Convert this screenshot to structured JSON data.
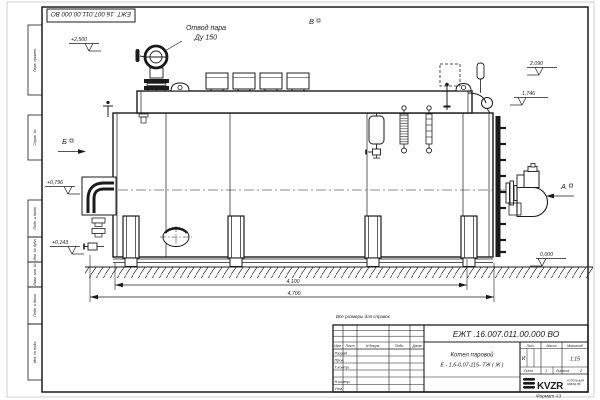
{
  "sheet": {
    "top_doc_number": "ЕЖТ .16.007.011.00.000  ВО",
    "reference_note": "Все размеры для справок",
    "format_note": "Формат  А3"
  },
  "frame_stamps": [
    "Перв. примен.",
    "Справ. №",
    "Подп. и дата",
    "Инв. № дубл.",
    "Взам. инв. №",
    "Подп. и дата",
    "Инв. № подл."
  ],
  "callouts": {
    "steam_outlet_line1": "Отвод пара",
    "steam_outlet_line2": "Ду 150",
    "view_b": "Б",
    "view_v": "В",
    "view_a": "А"
  },
  "elevations": {
    "valve_top": "+2,500",
    "drum_top": "2,090",
    "upper": "1,746",
    "burner_axis": "+0,796",
    "lower": "+0,143",
    "ground": "0,000"
  },
  "dimensions": {
    "boiler_length": "4,100",
    "overall_length": "4,700"
  },
  "title_block": {
    "doc_number": "ЕЖТ .16.007.011.00.000  ВО",
    "product_name_line1": "Котел паровой",
    "product_name_line2": "Е - 1,6-0,07-115- ТЖ ( Ж )",
    "col_headers": [
      "Изм.",
      "Лист",
      "N докум.",
      "Подп.",
      "Дата"
    ],
    "row_labels": [
      "Разраб.",
      "Пров.",
      "Т.контр.",
      "Н.контр.",
      "Утв."
    ],
    "lit_header": "Лит.",
    "mass_header": "Масса",
    "scale_header": "Масштаб",
    "lit_value": "И",
    "scale_value": "1:15",
    "sheet_label": "Лист",
    "sheet_value": "1",
    "sheets_label": "Листов",
    "sheets_value": "2",
    "logo_text": "KVZR",
    "logo_caption_line1": "КОТЕЛЬНЫЙ",
    "logo_caption_line2": "ЗАВОД РФ"
  }
}
